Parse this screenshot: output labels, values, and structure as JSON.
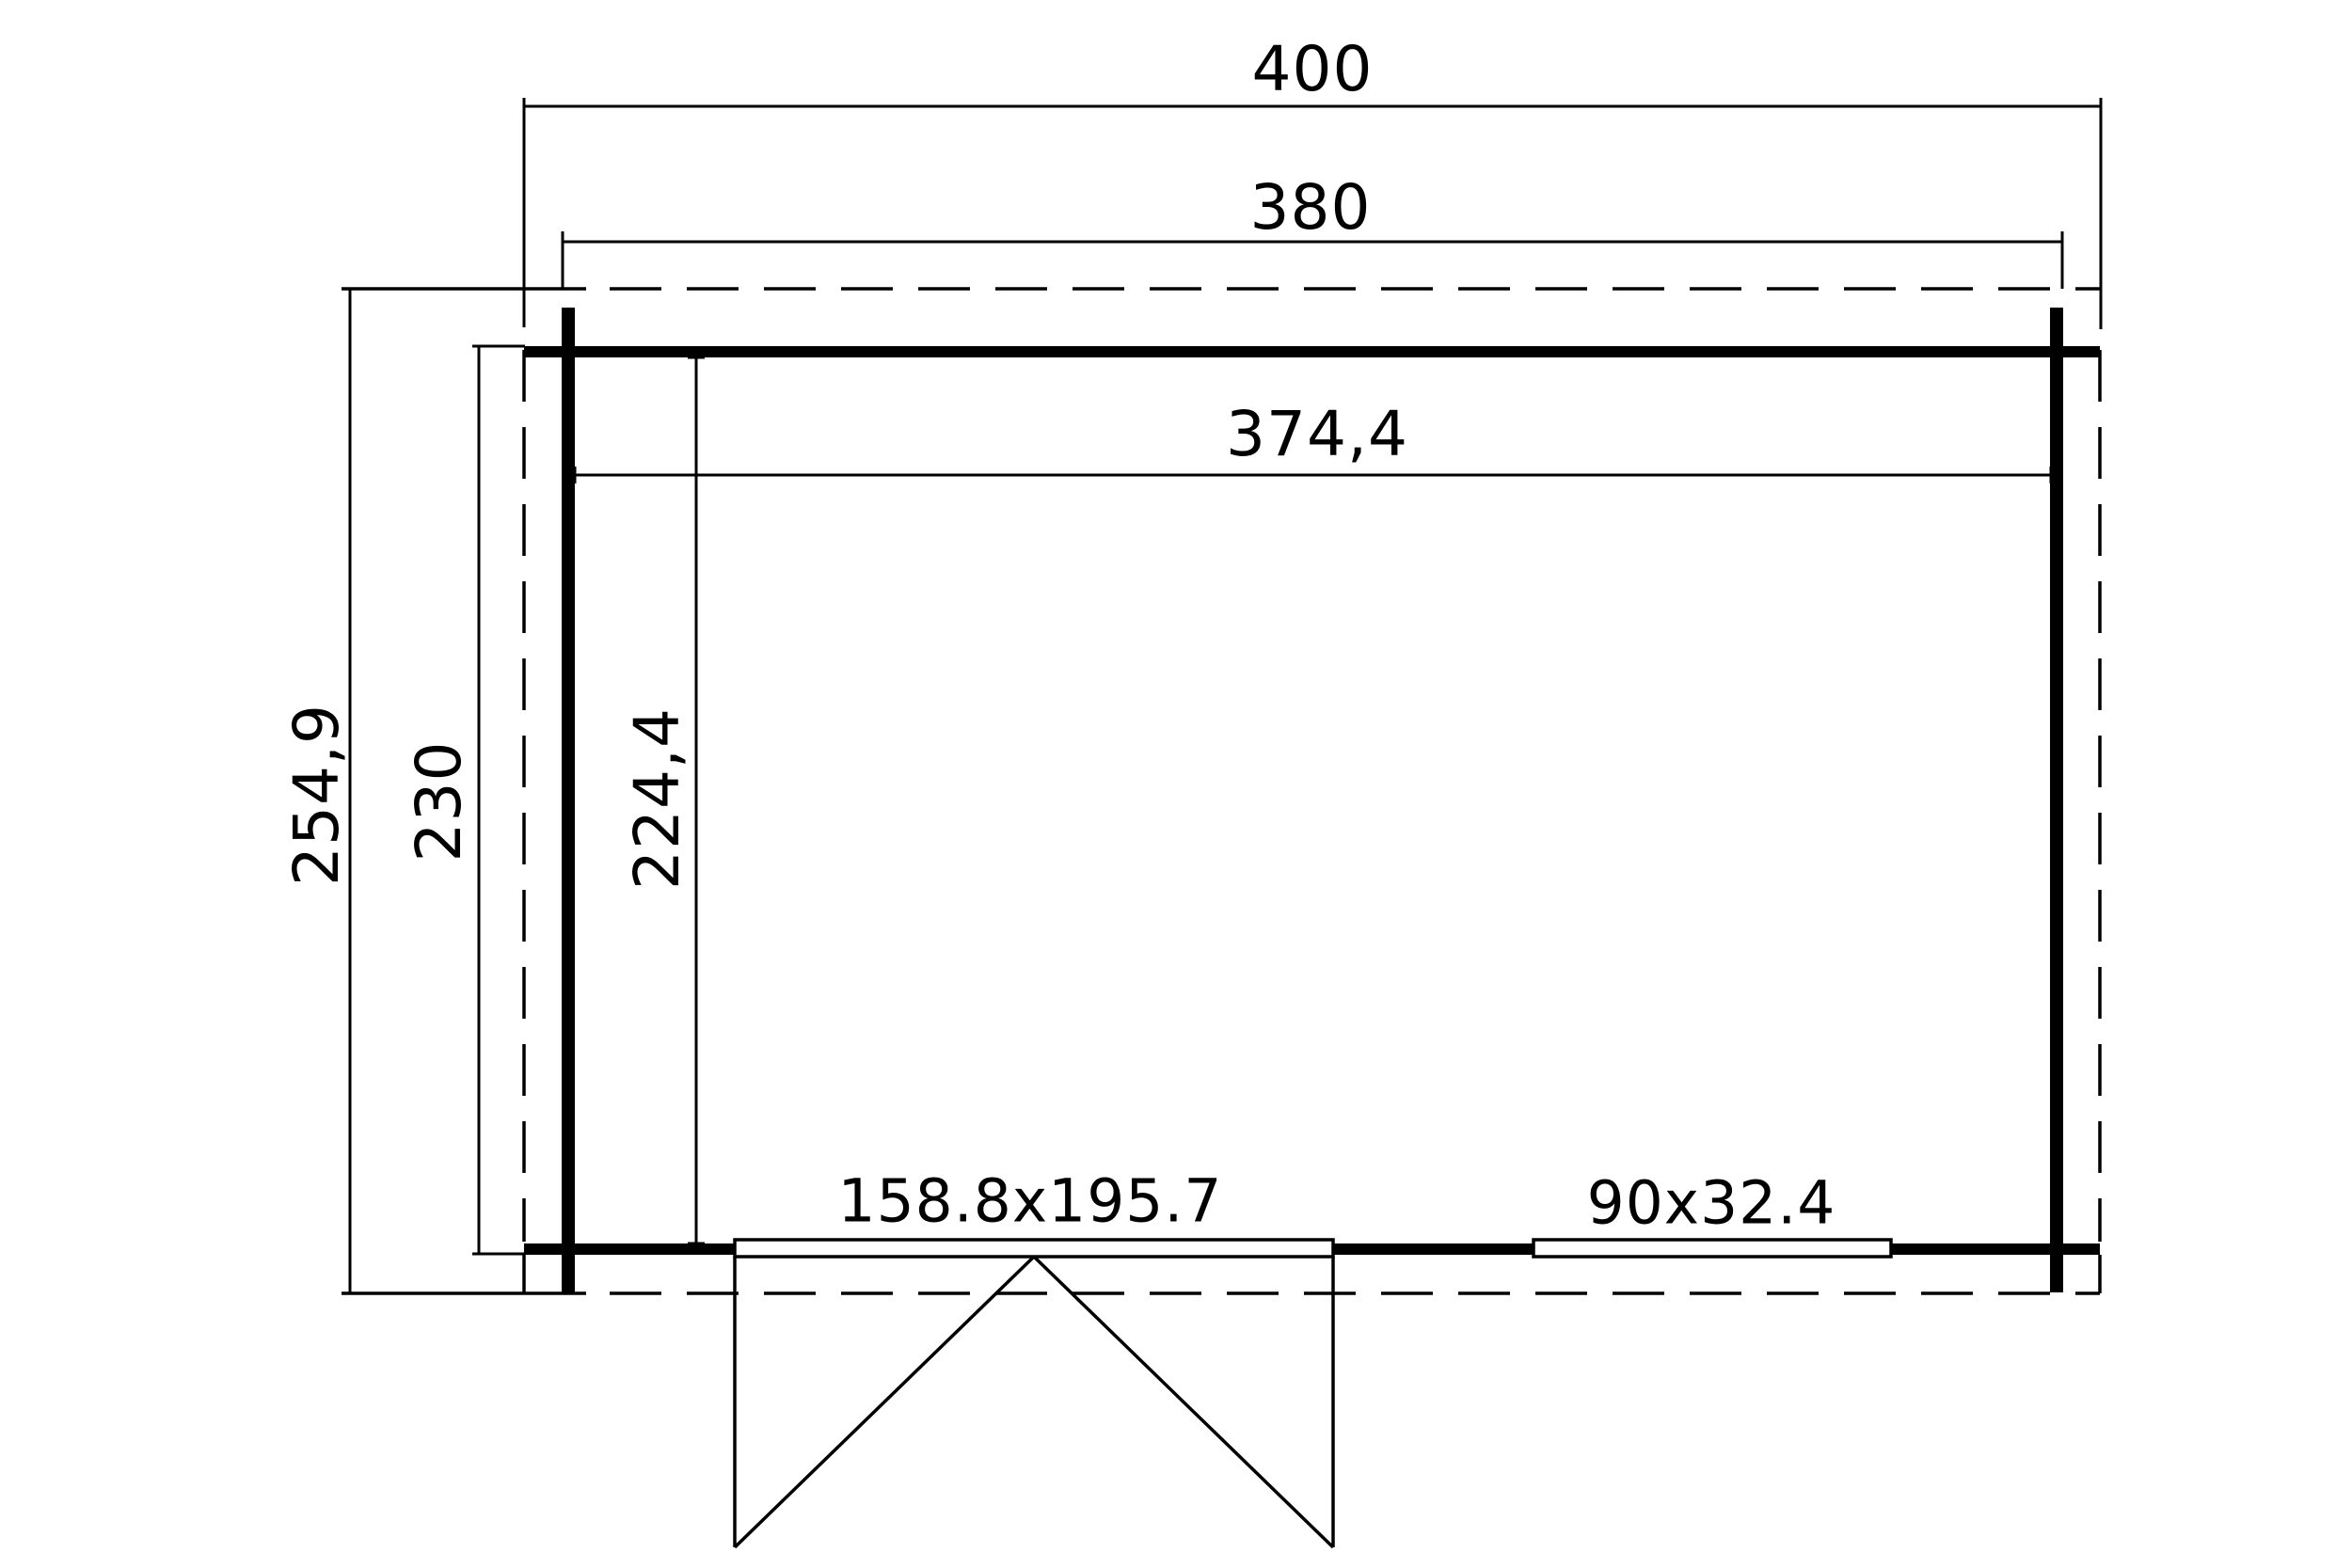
{
  "floorplan": {
    "dimensions": {
      "overall_width": "400",
      "outer_wall_width": "380",
      "inner_width": "374,4",
      "overall_depth": "254,9",
      "outer_wall_depth": "230",
      "inner_depth": "224,4"
    },
    "door": {
      "size_label": "158.8x195.7"
    },
    "window": {
      "size_label": "90x32.4"
    },
    "colors": {
      "line": "#000000",
      "background": "#ffffff"
    }
  }
}
